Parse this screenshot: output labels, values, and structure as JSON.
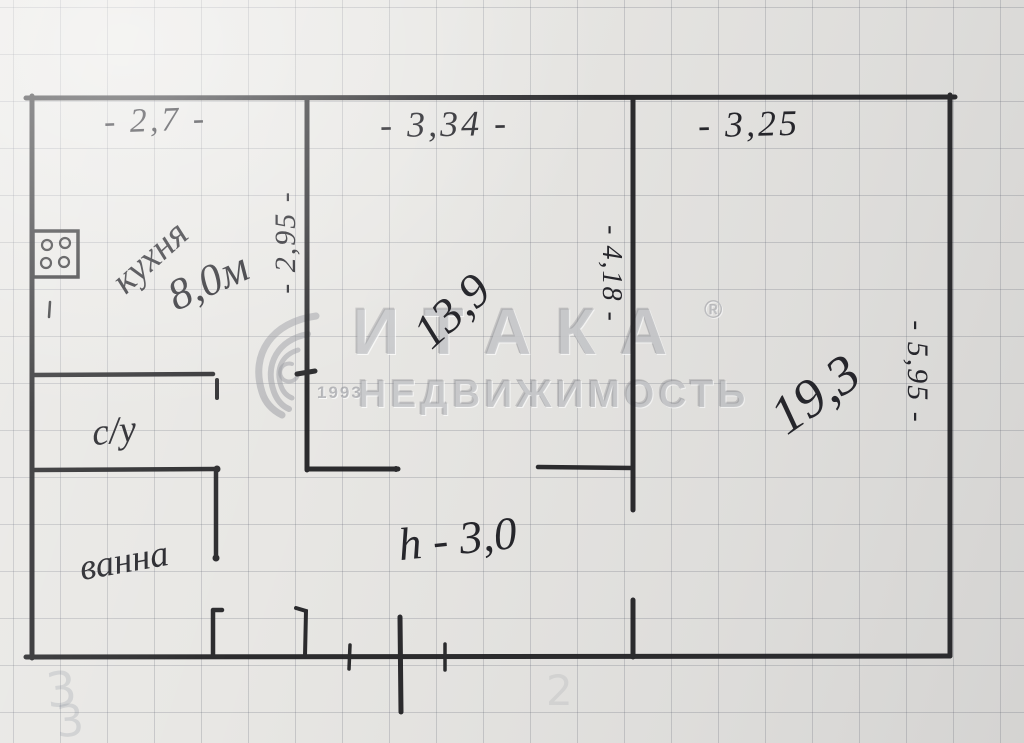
{
  "plan": {
    "dims": {
      "kitchen_width": "- 2,7 -",
      "hall_width": "- 3,34 -",
      "room_width": "- 3,25",
      "kitchen_wall": "- 2,95 -",
      "hall_wall": "- 4,18 -",
      "room_wall": "- 5,95 -",
      "ceiling_height": "h - 3,0"
    },
    "rooms": {
      "kitchen_label": "кухня",
      "kitchen_area": "8,0м",
      "hall_area": "13,9",
      "living_area": "19,3",
      "wc_label": "с/у",
      "bath_label": "ванна"
    }
  },
  "watermark": {
    "brand": "ИТАКА",
    "registered": "®",
    "year": "1993",
    "subtitle": "НЕДВИЖИМОСТЬ"
  },
  "ghost_marks": {
    "a": "3",
    "b": "3",
    "c": "2"
  }
}
